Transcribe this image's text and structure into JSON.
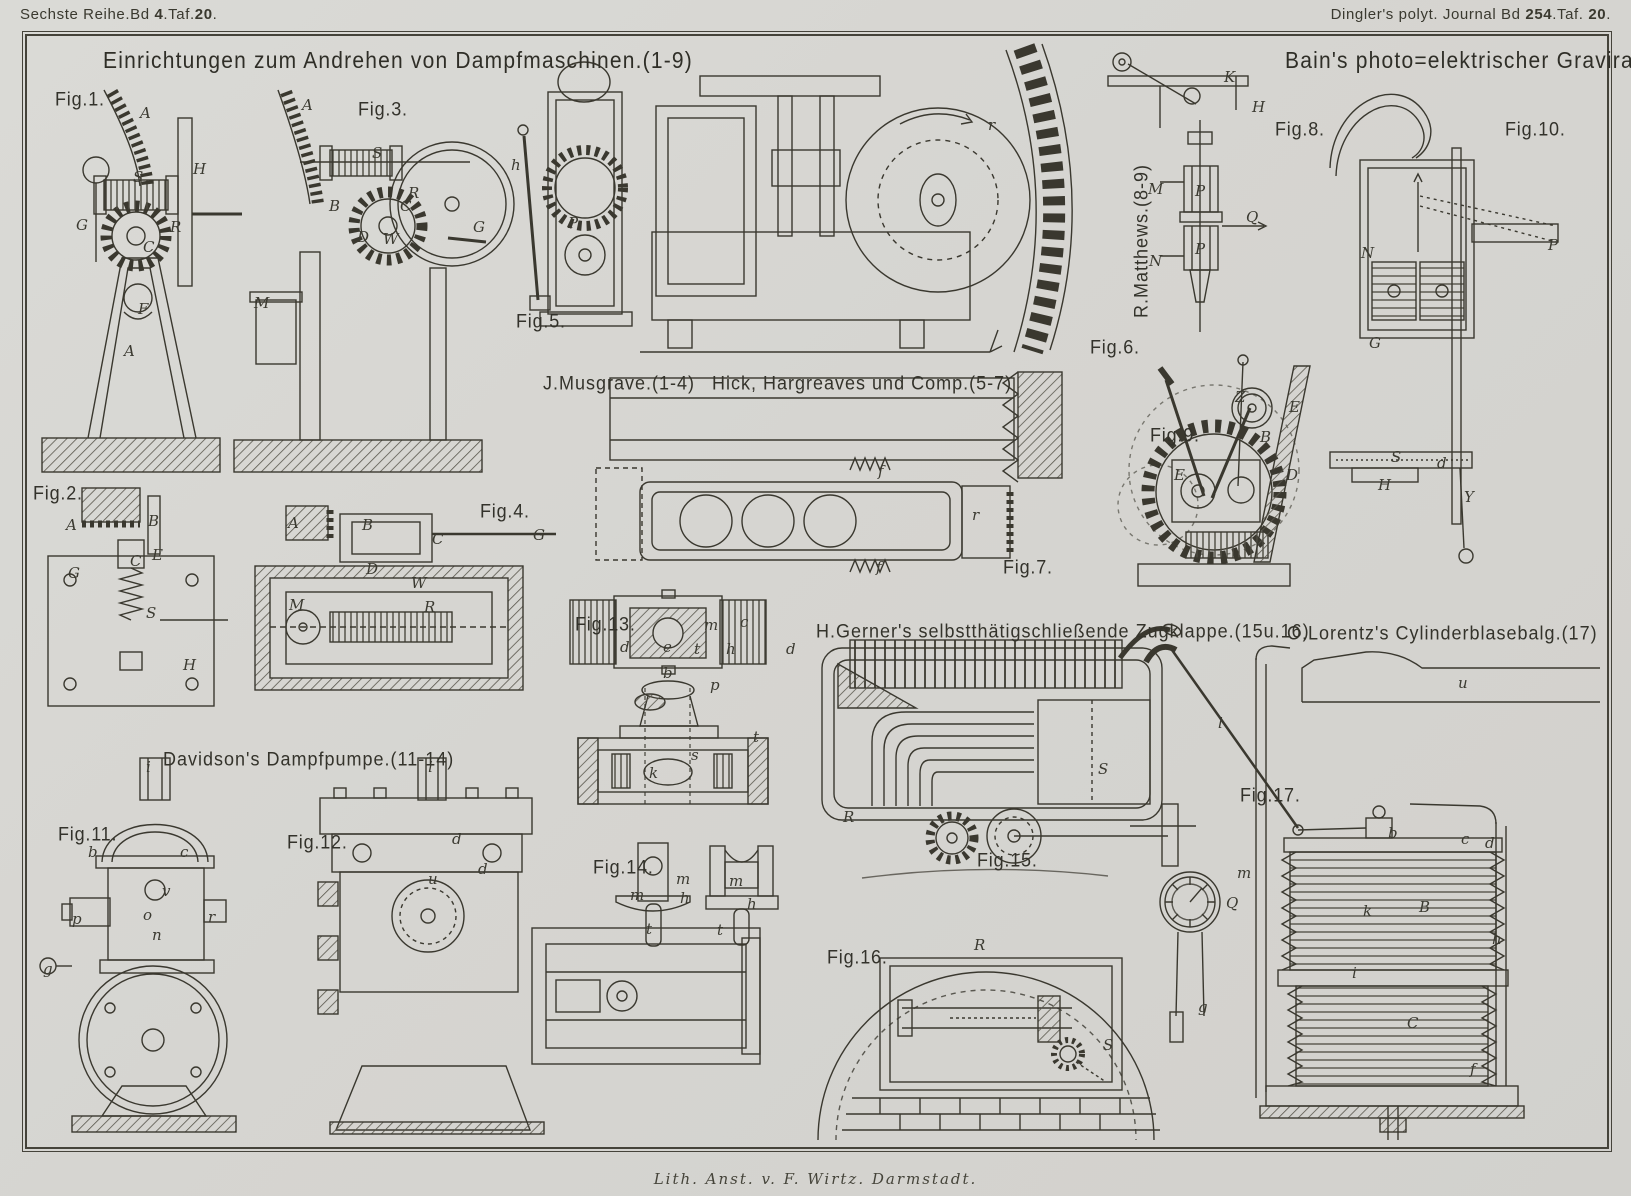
{
  "colors": {
    "paper": "#d6d5d1",
    "ink": "#3a382f",
    "frame": "#45433a"
  },
  "header": {
    "left_segments": [
      {
        "t": "Sechste Reihe.Bd ",
        "b": false
      },
      {
        "t": "4",
        "b": true
      },
      {
        "t": ".Taf.",
        "b": false
      },
      {
        "t": "20",
        "b": true
      },
      {
        "t": ".",
        "b": false
      }
    ],
    "right_segments": [
      {
        "t": "Dingler's polyt. Journal Bd ",
        "b": false
      },
      {
        "t": "254",
        "b": true
      },
      {
        "t": ".Taf. ",
        "b": false
      },
      {
        "t": "20",
        "b": true
      },
      {
        "t": ".",
        "b": false
      }
    ]
  },
  "titles": {
    "main": "Einrichtungen zum Andrehen von Dampfmaschinen.(1-9)",
    "right": "Bain's photo=elektrischer Gravirapparat.(10)"
  },
  "footer": "Lith. Anst. v. F. Wirtz. Darmstadt.",
  "captions": [
    {
      "name": "caption-musgrave",
      "text": "J.Musgrave.(1-4)",
      "x": 543,
      "y": 372
    },
    {
      "name": "caption-hick-hargreaves",
      "text": "Hick, Hargreaves und Comp.(5-7)",
      "x": 712,
      "y": 372
    },
    {
      "name": "caption-matthews",
      "text": "R.Matthews.(8-9)",
      "x": 1130,
      "y": 318,
      "vertical": true
    },
    {
      "name": "caption-davidson",
      "text": "Davidson's Dampfpumpe.(11-14)",
      "x": 163,
      "y": 748
    },
    {
      "name": "caption-gerner",
      "text": "H.Gerner's selbstthätigschließende Zugklappe.(15u.16)",
      "x": 816,
      "y": 620
    },
    {
      "name": "caption-lorentz",
      "text": "O.Lorentz's Cylinderblasebalg.(17)",
      "x": 1287,
      "y": 622
    }
  ],
  "figures": [
    {
      "id": 1,
      "label": "Fig.1.",
      "x": 55,
      "y": 88,
      "parts": [
        {
          "t": "A",
          "x": 140,
          "y": 104
        },
        {
          "t": "S",
          "x": 133,
          "y": 168
        },
        {
          "t": "H",
          "x": 193,
          "y": 160
        },
        {
          "t": "G",
          "x": 76,
          "y": 216
        },
        {
          "t": "R",
          "x": 170,
          "y": 218
        },
        {
          "t": "C",
          "x": 143,
          "y": 238
        },
        {
          "t": "F",
          "x": 138,
          "y": 300
        },
        {
          "t": "A",
          "x": 124,
          "y": 342
        }
      ]
    },
    {
      "id": 2,
      "label": "Fig.2.",
      "x": 33,
      "y": 482,
      "parts": [
        {
          "t": "A",
          "x": 66,
          "y": 516
        },
        {
          "t": "B",
          "x": 148,
          "y": 512
        },
        {
          "t": "E",
          "x": 152,
          "y": 546
        },
        {
          "t": "C",
          "x": 130,
          "y": 552
        },
        {
          "t": "G",
          "x": 68,
          "y": 564
        },
        {
          "t": "S",
          "x": 146,
          "y": 604
        },
        {
          "t": "H",
          "x": 183,
          "y": 656
        }
      ]
    },
    {
      "id": 3,
      "label": "Fig.3.",
      "x": 358,
      "y": 98,
      "parts": [
        {
          "t": "A",
          "x": 302,
          "y": 96
        },
        {
          "t": "S",
          "x": 372,
          "y": 144
        },
        {
          "t": "R",
          "x": 408,
          "y": 184
        },
        {
          "t": "C",
          "x": 400,
          "y": 197
        },
        {
          "t": "B",
          "x": 329,
          "y": 197
        },
        {
          "t": "D",
          "x": 357,
          "y": 228
        },
        {
          "t": "W",
          "x": 383,
          "y": 230
        },
        {
          "t": "G",
          "x": 473,
          "y": 218
        },
        {
          "t": "M",
          "x": 254,
          "y": 294
        }
      ]
    },
    {
      "id": 4,
      "label": "Fig.4.",
      "x": 480,
      "y": 500,
      "parts": [
        {
          "t": "A",
          "x": 288,
          "y": 514
        },
        {
          "t": "B",
          "x": 362,
          "y": 516
        },
        {
          "t": "C",
          "x": 432,
          "y": 530
        },
        {
          "t": "G",
          "x": 533,
          "y": 526
        },
        {
          "t": "D",
          "x": 366,
          "y": 560
        },
        {
          "t": "W",
          "x": 411,
          "y": 574
        },
        {
          "t": "M",
          "x": 289,
          "y": 596
        },
        {
          "t": "R",
          "x": 424,
          "y": 598
        }
      ]
    },
    {
      "id": 5,
      "label": "Fig.5.",
      "x": 516,
      "y": 310,
      "parts": [
        {
          "t": "h",
          "x": 511,
          "y": 156
        },
        {
          "t": "P",
          "x": 568,
          "y": 214
        }
      ]
    },
    {
      "id": 6,
      "label": "Fig.6.",
      "x": 1090,
      "y": 336,
      "parts": [
        {
          "t": "r",
          "x": 988,
          "y": 116
        }
      ]
    },
    {
      "id": 7,
      "label": "Fig.7.",
      "x": 1003,
      "y": 556,
      "parts": [
        {
          "t": "f",
          "x": 878,
          "y": 462
        },
        {
          "t": "r",
          "x": 972,
          "y": 506
        },
        {
          "t": "f",
          "x": 876,
          "y": 558
        }
      ]
    },
    {
      "id": 8,
      "label": "Fig.8.",
      "x": 1275,
      "y": 118,
      "parts": [
        {
          "t": "K",
          "x": 1224,
          "y": 68
        },
        {
          "t": "H",
          "x": 1252,
          "y": 98
        },
        {
          "t": "M",
          "x": 1148,
          "y": 180
        },
        {
          "t": "P",
          "x": 1195,
          "y": 182
        },
        {
          "t": "Q",
          "x": 1246,
          "y": 208
        },
        {
          "t": "N",
          "x": 1149,
          "y": 252
        },
        {
          "t": "P",
          "x": 1195,
          "y": 240
        }
      ]
    },
    {
      "id": 9,
      "label": "Fig.9.",
      "x": 1150,
      "y": 424,
      "parts": [
        {
          "t": "Z",
          "x": 1235,
          "y": 388
        },
        {
          "t": "E",
          "x": 1289,
          "y": 398
        },
        {
          "t": "E",
          "x": 1174,
          "y": 466
        },
        {
          "t": "B",
          "x": 1260,
          "y": 428
        },
        {
          "t": "D",
          "x": 1286,
          "y": 466
        }
      ]
    },
    {
      "id": 10,
      "label": "Fig.10.",
      "x": 1505,
      "y": 118,
      "parts": [
        {
          "t": "P",
          "x": 1548,
          "y": 236
        },
        {
          "t": "N",
          "x": 1361,
          "y": 244
        },
        {
          "t": "G",
          "x": 1369,
          "y": 334
        },
        {
          "t": "S",
          "x": 1391,
          "y": 448
        },
        {
          "t": "d",
          "x": 1437,
          "y": 454
        },
        {
          "t": "H",
          "x": 1378,
          "y": 476
        },
        {
          "t": "Y",
          "x": 1464,
          "y": 488
        }
      ]
    },
    {
      "id": 11,
      "label": "Fig.11.",
      "x": 58,
      "y": 823,
      "parts": [
        {
          "t": "i",
          "x": 146,
          "y": 758
        },
        {
          "t": "b",
          "x": 88,
          "y": 843
        },
        {
          "t": "c",
          "x": 180,
          "y": 843
        },
        {
          "t": "v",
          "x": 162,
          "y": 882
        },
        {
          "t": "o",
          "x": 143,
          "y": 906
        },
        {
          "t": "p",
          "x": 72,
          "y": 910
        },
        {
          "t": "r",
          "x": 208,
          "y": 908
        },
        {
          "t": "n",
          "x": 152,
          "y": 926
        },
        {
          "t": "g",
          "x": 43,
          "y": 960
        }
      ]
    },
    {
      "id": 12,
      "label": "Fig.12.",
      "x": 287,
      "y": 831,
      "parts": [
        {
          "t": "i",
          "x": 428,
          "y": 758
        },
        {
          "t": "d",
          "x": 452,
          "y": 830
        },
        {
          "t": "d",
          "x": 478,
          "y": 860
        },
        {
          "t": "u",
          "x": 428,
          "y": 870
        }
      ]
    },
    {
      "id": 13,
      "label": "Fig.13.",
      "x": 575,
      "y": 613,
      "parts": [
        {
          "t": "m",
          "x": 704,
          "y": 616
        },
        {
          "t": "c",
          "x": 740,
          "y": 613
        },
        {
          "t": "d",
          "x": 620,
          "y": 638
        },
        {
          "t": "e",
          "x": 663,
          "y": 638
        },
        {
          "t": "t",
          "x": 694,
          "y": 640
        },
        {
          "t": "h",
          "x": 726,
          "y": 640
        },
        {
          "t": "d",
          "x": 786,
          "y": 640
        },
        {
          "t": "b",
          "x": 663,
          "y": 664
        },
        {
          "t": "p",
          "x": 710,
          "y": 676
        },
        {
          "t": "t",
          "x": 753,
          "y": 728
        },
        {
          "t": "s",
          "x": 691,
          "y": 746
        },
        {
          "t": "k",
          "x": 649,
          "y": 764
        }
      ]
    },
    {
      "id": 14,
      "label": "Fig.14.",
      "x": 593,
      "y": 856,
      "parts": [
        {
          "t": "m",
          "x": 676,
          "y": 870
        },
        {
          "t": "m",
          "x": 630,
          "y": 886
        },
        {
          "t": "h",
          "x": 680,
          "y": 889
        },
        {
          "t": "t",
          "x": 646,
          "y": 920
        },
        {
          "t": "m",
          "x": 729,
          "y": 872
        },
        {
          "t": "h",
          "x": 747,
          "y": 895
        },
        {
          "t": "t",
          "x": 717,
          "y": 921
        }
      ]
    },
    {
      "id": 15,
      "label": "Fig.15.",
      "x": 977,
      "y": 849,
      "parts": [
        {
          "t": "R",
          "x": 843,
          "y": 808
        },
        {
          "t": "S",
          "x": 1098,
          "y": 760
        }
      ]
    },
    {
      "id": 16,
      "label": "Fig.16.",
      "x": 827,
      "y": 946,
      "parts": [
        {
          "t": "R",
          "x": 974,
          "y": 936
        },
        {
          "t": "Q",
          "x": 1226,
          "y": 894
        },
        {
          "t": "g",
          "x": 1198,
          "y": 998
        },
        {
          "t": "S",
          "x": 1103,
          "y": 1036
        }
      ]
    },
    {
      "id": 17,
      "label": "Fig.17.",
      "x": 1240,
      "y": 784,
      "parts": [
        {
          "t": "u",
          "x": 1458,
          "y": 674
        },
        {
          "t": "l",
          "x": 1218,
          "y": 714
        },
        {
          "t": "b",
          "x": 1388,
          "y": 824
        },
        {
          "t": "c",
          "x": 1461,
          "y": 830
        },
        {
          "t": "d",
          "x": 1485,
          "y": 834
        },
        {
          "t": "m",
          "x": 1237,
          "y": 864
        },
        {
          "t": "k",
          "x": 1363,
          "y": 902
        },
        {
          "t": "B",
          "x": 1419,
          "y": 898
        },
        {
          "t": "h",
          "x": 1492,
          "y": 930
        },
        {
          "t": "i",
          "x": 1352,
          "y": 964
        },
        {
          "t": "C",
          "x": 1407,
          "y": 1014
        },
        {
          "t": "f",
          "x": 1470,
          "y": 1060
        }
      ]
    }
  ]
}
